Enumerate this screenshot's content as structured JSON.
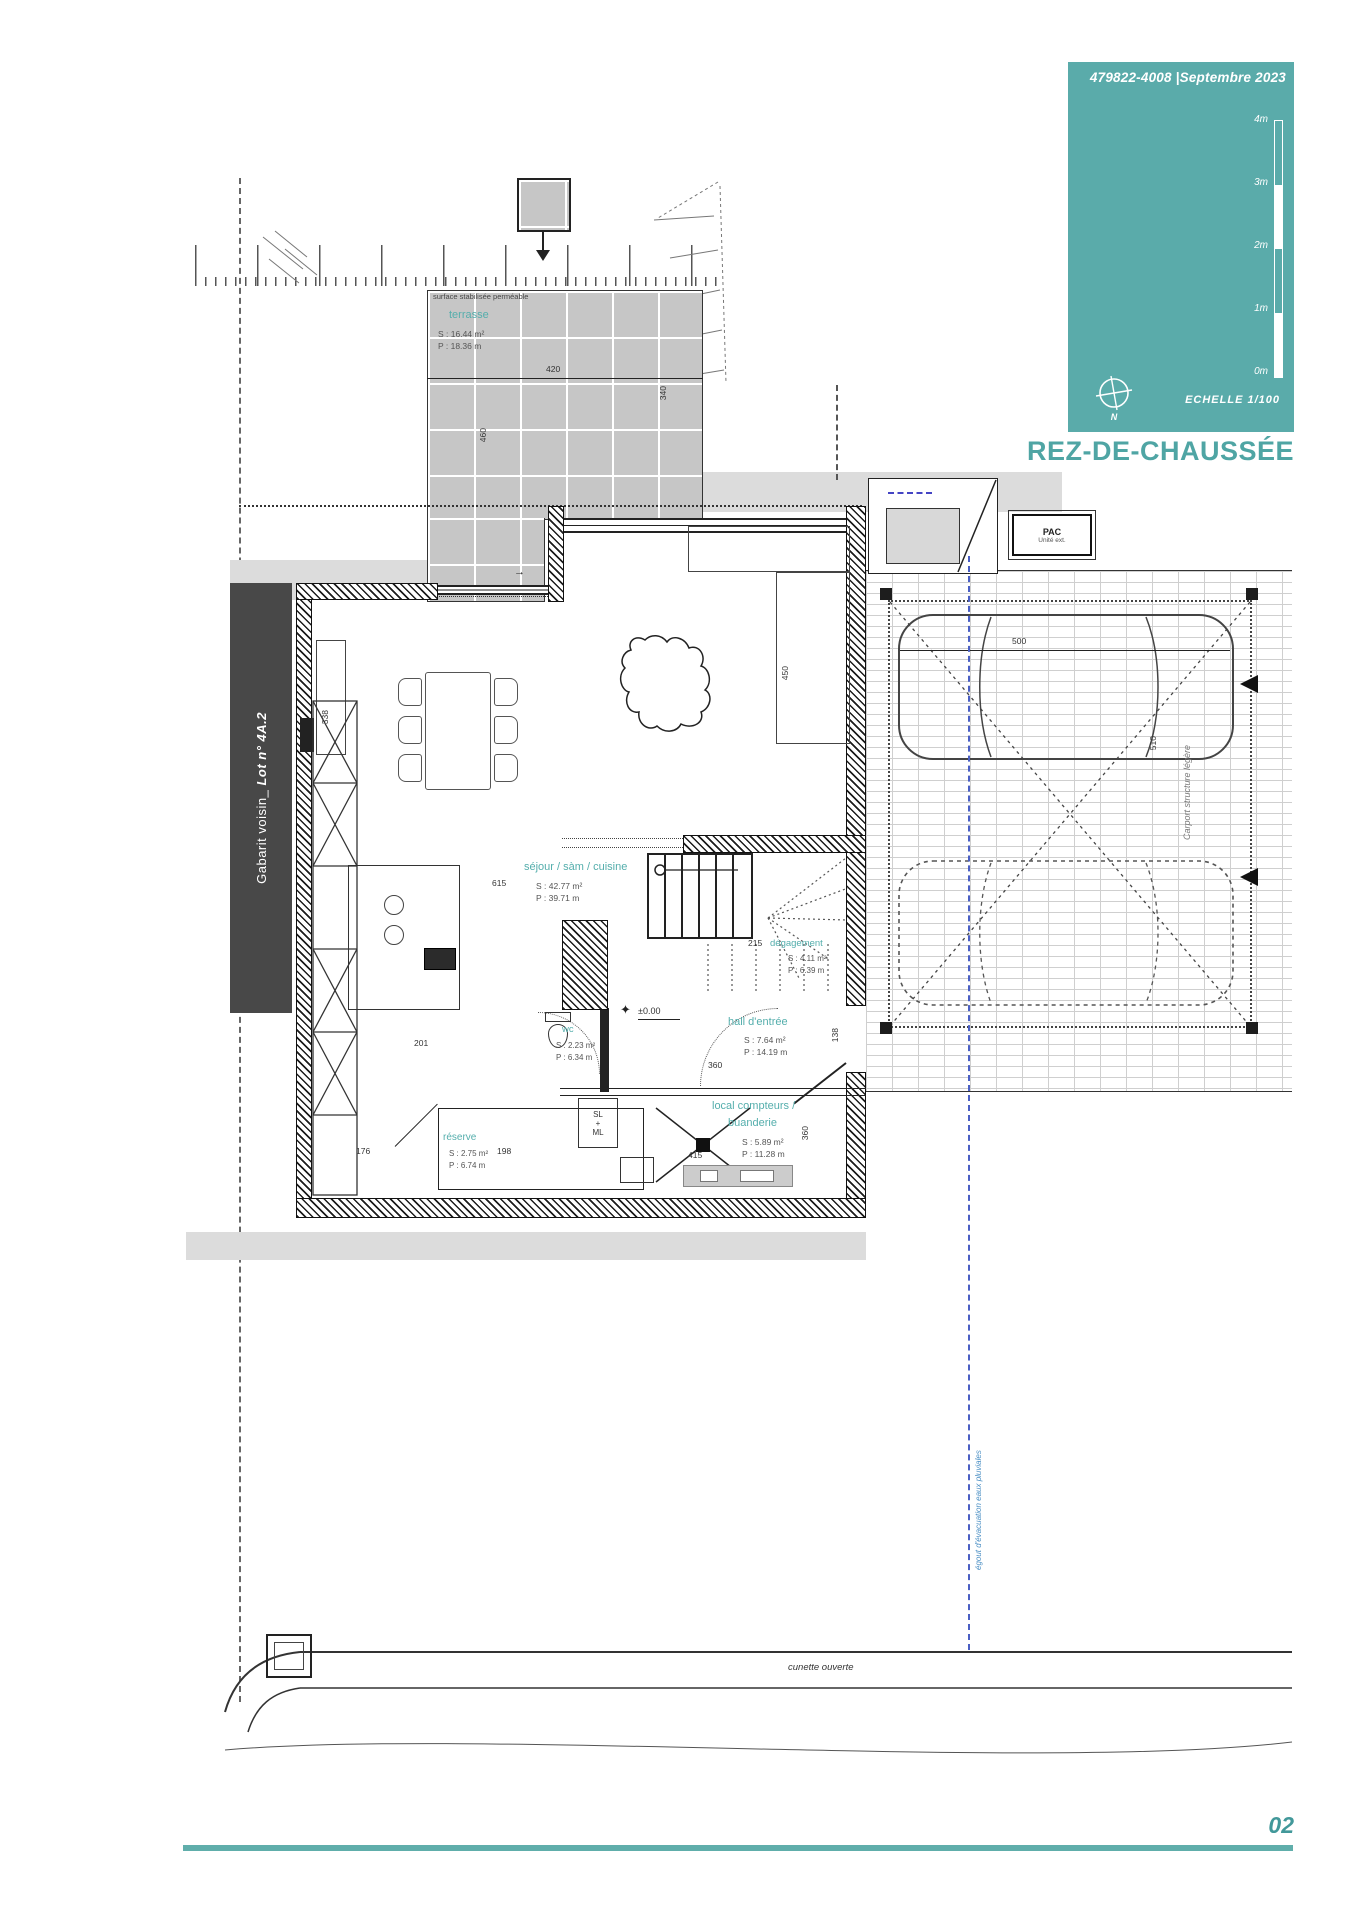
{
  "titleblock": {
    "ref": "479822-4008",
    "sep": "|",
    "date": "Septembre 2023",
    "scale_labels": [
      "4m",
      "3m",
      "2m",
      "1m",
      "0m"
    ],
    "north": "N",
    "echelle": "ECHELLE  1/100",
    "sheet_title": "REZ-DE-CHAUSSÉE"
  },
  "footer": {
    "page": "02"
  },
  "neighbor": {
    "prefix": "Gabarit voisin_ ",
    "lot": "Lot n° 4A.2"
  },
  "site": {
    "surface_note": "surface stabilisée perméable",
    "cunette": "cunette ouverte",
    "rainwater": "égout d'évacuation eaux pluviales",
    "carport": "Carport structure légère",
    "pac": "PAC",
    "pac_sub": "Unité ext."
  },
  "rooms": {
    "terrasse": {
      "label": "terrasse",
      "s": "S : 16.44 m²",
      "p": "P : 18.36 m"
    },
    "sejour": {
      "label": "séjour / sàm / cuisine",
      "s": "S : 42.77 m²",
      "p": "P : 39.71 m"
    },
    "degagement": {
      "label": "dégagement",
      "s": "S : 4.11 m²",
      "p": "P : 6.39 m"
    },
    "hall": {
      "label": "hall d'entrée",
      "s": "S : 7.64 m²",
      "p": "P : 14.19 m"
    },
    "wc": {
      "label": "wc",
      "s": "S : 2.23 m²",
      "p": "P : 6.34 m"
    },
    "reserve": {
      "label": "réserve",
      "s": "S : 2.75 m²",
      "p": "P : 6.74 m"
    },
    "local": {
      "label1": "local compteurs /",
      "label2": "buanderie",
      "s": "S : 5.89 m²",
      "p": "P : 11.28 m"
    }
  },
  "appliances": {
    "sl": "SL",
    "plus": "+",
    "ml": "ML"
  },
  "levels": {
    "ground": "±0.00"
  },
  "dims": {
    "t420": "420",
    "t460": "460",
    "t340": "340",
    "s338": "338",
    "s450": "450",
    "s615": "615",
    "st215": "215",
    "h360": "360",
    "h201": "201",
    "h138": "138",
    "r176": "176",
    "r198": "198",
    "l415": "415",
    "l360": "360",
    "c500": "500",
    "c510": "510"
  }
}
